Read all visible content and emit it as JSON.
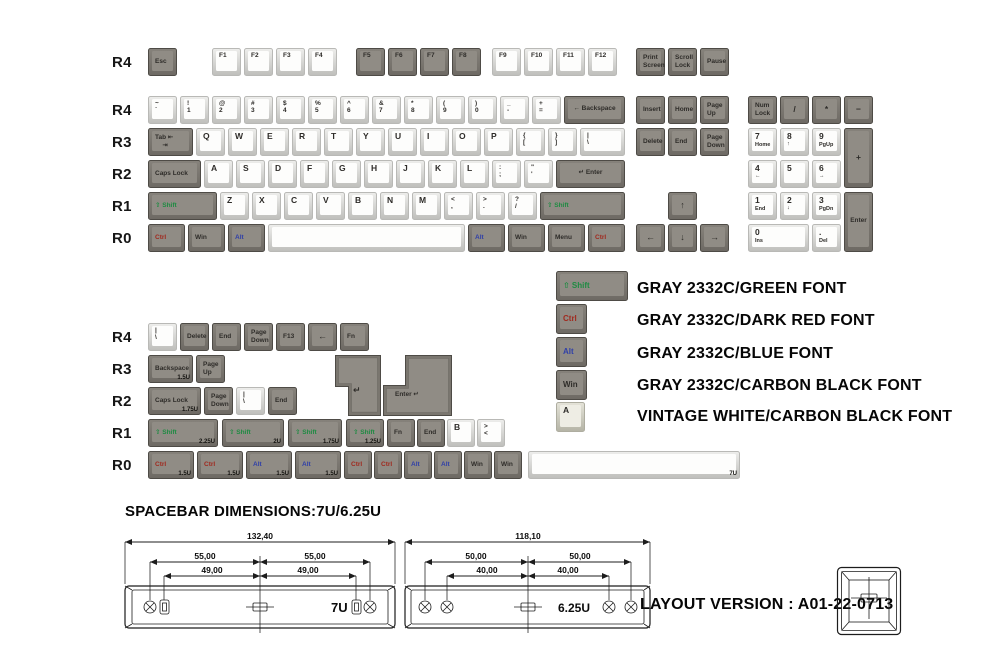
{
  "colors": {
    "green": "#1e8b42",
    "dark_red": "#a02a1f",
    "blue": "#3040a8",
    "carbon_black": "#2e2c29",
    "gray_keycap": "#908c85",
    "vintage_white": "#eeede4"
  },
  "texts": {
    "spacebar_note": "SPACEBAR DIMENSIONS:7U/6.25U",
    "layout_version": "LAYOUT VERSION : A01-22-0713"
  },
  "legend_panel": {
    "entries": [
      "GRAY 2332C/GREEN FONT",
      "GRAY 2332C/DARK RED FONT",
      "GRAY 2332C/BLUE FONT",
      "GRAY 2332C/CARBON BLACK FONT",
      "VINTAGE WHITE/CARBON BLACK FONT"
    ]
  },
  "diagrams": {
    "d7u": {
      "total": "132,40",
      "outer": "55,00",
      "inner": "49,00",
      "label": "7U"
    },
    "d625": {
      "total": "118,10",
      "outer": "50,00",
      "inner": "40,00",
      "label": "6.25U"
    }
  },
  "row_labels_main": [
    {
      "t": "R4",
      "y": 54
    },
    {
      "t": "R4",
      "y": 102
    },
    {
      "t": "R3",
      "y": 134
    },
    {
      "t": "R2",
      "y": 166
    },
    {
      "t": "R1",
      "y": 198
    },
    {
      "t": "R0",
      "y": 230
    }
  ],
  "row_labels_second": [
    {
      "t": "R4",
      "y": 329
    },
    {
      "t": "R3",
      "y": 361
    },
    {
      "t": "R2",
      "y": 393
    },
    {
      "t": "R1",
      "y": 425
    },
    {
      "t": "R0",
      "y": 457
    }
  ],
  "keys_main": [
    {
      "x": 148,
      "y": 48,
      "l": [
        "Esc"
      ]
    },
    {
      "x": 212,
      "y": 48,
      "c": "w",
      "l": [
        "F1"
      ]
    },
    {
      "x": 244,
      "y": 48,
      "c": "w",
      "l": [
        "F2"
      ]
    },
    {
      "x": 276,
      "y": 48,
      "c": "w",
      "l": [
        "F3"
      ]
    },
    {
      "x": 308,
      "y": 48,
      "c": "w",
      "l": [
        "F4"
      ]
    },
    {
      "x": 356,
      "y": 48,
      "l": [
        "F5"
      ],
      "pos": "tl"
    },
    {
      "x": 388,
      "y": 48,
      "l": [
        "F6"
      ],
      "pos": "tl"
    },
    {
      "x": 420,
      "y": 48,
      "l": [
        "F7"
      ],
      "pos": "tl"
    },
    {
      "x": 452,
      "y": 48,
      "l": [
        "F8"
      ],
      "pos": "tl"
    },
    {
      "x": 492,
      "y": 48,
      "c": "w",
      "l": [
        "F9"
      ]
    },
    {
      "x": 524,
      "y": 48,
      "c": "w",
      "l": [
        "F10"
      ]
    },
    {
      "x": 556,
      "y": 48,
      "c": "w",
      "l": [
        "F11"
      ]
    },
    {
      "x": 588,
      "y": 48,
      "c": "w",
      "l": [
        "F12"
      ]
    },
    {
      "x": 636,
      "y": 48,
      "l": [
        "Print",
        "Screen"
      ]
    },
    {
      "x": 668,
      "y": 48,
      "l": [
        "Scroll",
        "Lock"
      ]
    },
    {
      "x": 700,
      "y": 48,
      "l": [
        "Pause"
      ]
    },
    {
      "x": 148,
      "y": 96,
      "c": "w",
      "l": [
        "~",
        "`"
      ]
    },
    {
      "x": 180,
      "y": 96,
      "c": "w",
      "l": [
        "!",
        "1"
      ]
    },
    {
      "x": 212,
      "y": 96,
      "c": "w",
      "l": [
        "@",
        "2"
      ]
    },
    {
      "x": 244,
      "y": 96,
      "c": "w",
      "l": [
        "#",
        "3"
      ]
    },
    {
      "x": 276,
      "y": 96,
      "c": "w",
      "l": [
        "$",
        "4"
      ]
    },
    {
      "x": 308,
      "y": 96,
      "c": "w",
      "l": [
        "%",
        "5"
      ]
    },
    {
      "x": 340,
      "y": 96,
      "c": "w",
      "l": [
        "^",
        "6"
      ]
    },
    {
      "x": 372,
      "y": 96,
      "c": "w",
      "l": [
        "&",
        "7"
      ]
    },
    {
      "x": 404,
      "y": 96,
      "c": "w",
      "l": [
        "*",
        "8"
      ]
    },
    {
      "x": 436,
      "y": 96,
      "c": "w",
      "l": [
        "(",
        "9"
      ]
    },
    {
      "x": 468,
      "y": 96,
      "c": "w",
      "l": [
        ")",
        "0"
      ]
    },
    {
      "x": 500,
      "y": 96,
      "c": "w",
      "l": [
        "_",
        "-"
      ]
    },
    {
      "x": 532,
      "y": 96,
      "c": "w",
      "l": [
        "+",
        "="
      ]
    },
    {
      "x": 564,
      "y": 96,
      "w": 61,
      "l": [
        "← Backspace"
      ],
      "pos": "c"
    },
    {
      "x": 636,
      "y": 96,
      "l": [
        "Insert"
      ]
    },
    {
      "x": 668,
      "y": 96,
      "l": [
        "Home"
      ]
    },
    {
      "x": 700,
      "y": 96,
      "l": [
        "Page",
        "Up"
      ]
    },
    {
      "x": 748,
      "y": 96,
      "l": [
        "Num",
        "Lock"
      ]
    },
    {
      "x": 780,
      "y": 96,
      "l": [
        "/"
      ],
      "pos": "c"
    },
    {
      "x": 812,
      "y": 96,
      "l": [
        "*"
      ],
      "pos": "c"
    },
    {
      "x": 844,
      "y": 96,
      "l": [
        "−"
      ],
      "pos": "c"
    },
    {
      "x": 148,
      "y": 128,
      "w": 45,
      "l": [
        "Tab ⇤",
        "    ⇥"
      ]
    },
    {
      "x": 196,
      "y": 128,
      "c": "w",
      "l": [
        "Q"
      ]
    },
    {
      "x": 228,
      "y": 128,
      "c": "w",
      "l": [
        "W"
      ]
    },
    {
      "x": 260,
      "y": 128,
      "c": "w",
      "l": [
        "E"
      ]
    },
    {
      "x": 292,
      "y": 128,
      "c": "w",
      "l": [
        "R"
      ]
    },
    {
      "x": 324,
      "y": 128,
      "c": "w",
      "l": [
        "T"
      ]
    },
    {
      "x": 356,
      "y": 128,
      "c": "w",
      "l": [
        "Y"
      ]
    },
    {
      "x": 388,
      "y": 128,
      "c": "w",
      "l": [
        "U"
      ]
    },
    {
      "x": 420,
      "y": 128,
      "c": "w",
      "l": [
        "I"
      ]
    },
    {
      "x": 452,
      "y": 128,
      "c": "w",
      "l": [
        "O"
      ]
    },
    {
      "x": 484,
      "y": 128,
      "c": "w",
      "l": [
        "P"
      ]
    },
    {
      "x": 516,
      "y": 128,
      "c": "w",
      "l": [
        "{",
        "["
      ]
    },
    {
      "x": 548,
      "y": 128,
      "c": "w",
      "l": [
        "}",
        "]"
      ]
    },
    {
      "x": 580,
      "y": 128,
      "w": 45,
      "c": "w",
      "l": [
        "|",
        "\\"
      ]
    },
    {
      "x": 636,
      "y": 128,
      "l": [
        "Delete"
      ]
    },
    {
      "x": 668,
      "y": 128,
      "l": [
        "End"
      ]
    },
    {
      "x": 700,
      "y": 128,
      "l": [
        "Page",
        "Down"
      ]
    },
    {
      "x": 748,
      "y": 128,
      "c": "w",
      "np": 1,
      "l": [
        "7",
        "Home"
      ]
    },
    {
      "x": 780,
      "y": 128,
      "c": "w",
      "np": 1,
      "l": [
        "8",
        "↑"
      ]
    },
    {
      "x": 812,
      "y": 128,
      "c": "w",
      "np": 1,
      "l": [
        "9",
        "PgUp"
      ]
    },
    {
      "x": 844,
      "y": 128,
      "h": 60,
      "l": [
        "+"
      ],
      "pos": "c"
    },
    {
      "x": 148,
      "y": 160,
      "w": 53,
      "l": [
        "Caps Lock"
      ]
    },
    {
      "x": 204,
      "y": 160,
      "c": "w",
      "l": [
        "A"
      ]
    },
    {
      "x": 236,
      "y": 160,
      "c": "w",
      "l": [
        "S"
      ]
    },
    {
      "x": 268,
      "y": 160,
      "c": "w",
      "l": [
        "D"
      ]
    },
    {
      "x": 300,
      "y": 160,
      "c": "w",
      "l": [
        "F"
      ]
    },
    {
      "x": 332,
      "y": 160,
      "c": "w",
      "l": [
        "G"
      ]
    },
    {
      "x": 364,
      "y": 160,
      "c": "w",
      "l": [
        "H"
      ]
    },
    {
      "x": 396,
      "y": 160,
      "c": "w",
      "l": [
        "J"
      ]
    },
    {
      "x": 428,
      "y": 160,
      "c": "w",
      "l": [
        "K"
      ]
    },
    {
      "x": 460,
      "y": 160,
      "c": "w",
      "l": [
        "L"
      ]
    },
    {
      "x": 492,
      "y": 160,
      "c": "w",
      "l": [
        ":",
        ";"
      ]
    },
    {
      "x": 524,
      "y": 160,
      "c": "w",
      "l": [
        "\"",
        "'"
      ]
    },
    {
      "x": 556,
      "y": 160,
      "w": 69,
      "l": [
        "↵ Enter"
      ],
      "pos": "c"
    },
    {
      "x": 748,
      "y": 160,
      "c": "w",
      "np": 1,
      "l": [
        "4",
        "←"
      ]
    },
    {
      "x": 780,
      "y": 160,
      "c": "w",
      "np": 1,
      "l": [
        "5"
      ]
    },
    {
      "x": 812,
      "y": 160,
      "c": "w",
      "np": 1,
      "l": [
        "6",
        "→"
      ]
    },
    {
      "x": 148,
      "y": 192,
      "w": 69,
      "l": [
        "⇧ Shift"
      ],
      "lc": "gr"
    },
    {
      "x": 220,
      "y": 192,
      "c": "w",
      "l": [
        "Z"
      ]
    },
    {
      "x": 252,
      "y": 192,
      "c": "w",
      "l": [
        "X"
      ]
    },
    {
      "x": 284,
      "y": 192,
      "c": "w",
      "l": [
        "C"
      ]
    },
    {
      "x": 316,
      "y": 192,
      "c": "w",
      "l": [
        "V"
      ]
    },
    {
      "x": 348,
      "y": 192,
      "c": "w",
      "l": [
        "B"
      ]
    },
    {
      "x": 380,
      "y": 192,
      "c": "w",
      "l": [
        "N"
      ]
    },
    {
      "x": 412,
      "y": 192,
      "c": "w",
      "l": [
        "M"
      ]
    },
    {
      "x": 444,
      "y": 192,
      "c": "w",
      "l": [
        "<",
        ","
      ]
    },
    {
      "x": 476,
      "y": 192,
      "c": "w",
      "l": [
        ">",
        "."
      ]
    },
    {
      "x": 508,
      "y": 192,
      "c": "w",
      "l": [
        "?",
        "/"
      ]
    },
    {
      "x": 540,
      "y": 192,
      "w": 85,
      "l": [
        "⇧ Shift"
      ],
      "lc": "gr"
    },
    {
      "x": 668,
      "y": 192,
      "l": [
        "↑"
      ],
      "pos": "c"
    },
    {
      "x": 748,
      "y": 192,
      "c": "w",
      "np": 1,
      "l": [
        "1",
        "End"
      ]
    },
    {
      "x": 780,
      "y": 192,
      "c": "w",
      "np": 1,
      "l": [
        "2",
        "↓"
      ]
    },
    {
      "x": 812,
      "y": 192,
      "c": "w",
      "np": 1,
      "l": [
        "3",
        "PgDn"
      ]
    },
    {
      "x": 844,
      "y": 192,
      "h": 60,
      "l": [
        "Enter"
      ],
      "pos": "c"
    },
    {
      "x": 148,
      "y": 224,
      "w": 37,
      "l": [
        "Ctrl"
      ],
      "lc": "rd"
    },
    {
      "x": 188,
      "y": 224,
      "w": 37,
      "l": [
        "Win"
      ]
    },
    {
      "x": 228,
      "y": 224,
      "w": 37,
      "l": [
        "Alt"
      ],
      "lc": "bl"
    },
    {
      "n": "key-spacebar",
      "x": 268,
      "y": 224,
      "w": 197,
      "c": "w",
      "l": []
    },
    {
      "x": 468,
      "y": 224,
      "w": 37,
      "l": [
        "Alt"
      ],
      "lc": "bl"
    },
    {
      "x": 508,
      "y": 224,
      "w": 37,
      "l": [
        "Win"
      ]
    },
    {
      "x": 548,
      "y": 224,
      "w": 37,
      "l": [
        "Menu"
      ]
    },
    {
      "x": 588,
      "y": 224,
      "w": 37,
      "l": [
        "Ctrl"
      ],
      "lc": "rd"
    },
    {
      "x": 636,
      "y": 224,
      "l": [
        "←"
      ],
      "pos": "c"
    },
    {
      "x": 668,
      "y": 224,
      "l": [
        "↓"
      ],
      "pos": "c"
    },
    {
      "x": 700,
      "y": 224,
      "l": [
        "→"
      ],
      "pos": "c"
    },
    {
      "x": 748,
      "y": 224,
      "w": 61,
      "c": "w",
      "np": 1,
      "l": [
        "0",
        "Ins"
      ]
    },
    {
      "x": 812,
      "y": 224,
      "c": "w",
      "np": 1,
      "l": [
        ".",
        "Del"
      ]
    }
  ],
  "keys_second": [
    {
      "x": 148,
      "y": 323,
      "c": "w",
      "l": [
        "|",
        "\\"
      ]
    },
    {
      "x": 180,
      "y": 323,
      "l": [
        "Delete"
      ]
    },
    {
      "x": 212,
      "y": 323,
      "l": [
        "End"
      ]
    },
    {
      "x": 244,
      "y": 323,
      "l": [
        "Page",
        "Down"
      ]
    },
    {
      "x": 276,
      "y": 323,
      "l": [
        "F13"
      ]
    },
    {
      "x": 308,
      "y": 323,
      "l": [
        "←"
      ],
      "pos": "c"
    },
    {
      "x": 340,
      "y": 323,
      "l": [
        "Fn"
      ]
    },
    {
      "x": 148,
      "y": 355,
      "w": 45,
      "l": [
        "Backspace"
      ],
      "sub": "1.5U"
    },
    {
      "x": 196,
      "y": 355,
      "l": [
        "Page",
        "Up"
      ]
    },
    {
      "x": 148,
      "y": 387,
      "w": 53,
      "l": [
        "Caps Lock"
      ],
      "sub": "1.75U"
    },
    {
      "x": 204,
      "y": 387,
      "l": [
        "Page",
        "Down"
      ]
    },
    {
      "x": 236,
      "y": 387,
      "c": "w",
      "l": [
        "|",
        "\\"
      ]
    },
    {
      "x": 268,
      "y": 387,
      "l": [
        "End"
      ]
    },
    {
      "x": 148,
      "y": 419,
      "w": 70,
      "l": [
        "⇧ Shift"
      ],
      "lc": "gr",
      "sub": "2.25U"
    },
    {
      "x": 222,
      "y": 419,
      "w": 62,
      "l": [
        "⇧ Shift"
      ],
      "lc": "gr",
      "sub": "2U"
    },
    {
      "x": 288,
      "y": 419,
      "w": 54,
      "l": [
        "⇧ Shift"
      ],
      "lc": "gr",
      "sub": "1.75U"
    },
    {
      "x": 346,
      "y": 419,
      "w": 38,
      "l": [
        "⇧ Shift"
      ],
      "lc": "gr",
      "sub": "1.25U"
    },
    {
      "x": 387,
      "y": 419,
      "w": 28,
      "l": [
        "Fn"
      ]
    },
    {
      "x": 417,
      "y": 419,
      "w": 28,
      "l": [
        "End"
      ]
    },
    {
      "x": 447,
      "y": 419,
      "w": 28,
      "c": "w",
      "l": [
        "B"
      ]
    },
    {
      "x": 477,
      "y": 419,
      "w": 28,
      "c": "w",
      "l": [
        ">",
        "<"
      ]
    },
    {
      "x": 148,
      "y": 451,
      "w": 46,
      "l": [
        "Ctrl"
      ],
      "lc": "rd",
      "sub": "1.5U"
    },
    {
      "x": 197,
      "y": 451,
      "w": 46,
      "l": [
        "Ctrl"
      ],
      "lc": "rd",
      "sub": "1.5U"
    },
    {
      "x": 246,
      "y": 451,
      "w": 46,
      "l": [
        "Alt"
      ],
      "lc": "bl",
      "sub": "1.5U"
    },
    {
      "x": 295,
      "y": 451,
      "w": 46,
      "l": [
        "Alt"
      ],
      "lc": "bl",
      "sub": "1.5U"
    },
    {
      "x": 344,
      "y": 451,
      "w": 28,
      "l": [
        "Ctrl"
      ],
      "lc": "rd"
    },
    {
      "x": 374,
      "y": 451,
      "w": 28,
      "l": [
        "Ctrl"
      ],
      "lc": "rd"
    },
    {
      "x": 404,
      "y": 451,
      "w": 28,
      "l": [
        "Alt"
      ],
      "lc": "bl"
    },
    {
      "x": 434,
      "y": 451,
      "w": 28,
      "l": [
        "Alt"
      ],
      "lc": "bl"
    },
    {
      "x": 464,
      "y": 451,
      "w": 28,
      "l": [
        "Win"
      ]
    },
    {
      "x": 494,
      "y": 451,
      "w": 28,
      "l": [
        "Win"
      ]
    },
    {
      "n": "key-spacebar-7u",
      "x": 528,
      "y": 451,
      "w": 212,
      "c": "w",
      "l": [],
      "sub": "7U"
    }
  ],
  "enter_keys": [
    {
      "n": "key-iso-enter",
      "x": 335,
      "y": 355,
      "kind": "iso",
      "legend": "↵"
    },
    {
      "n": "key-big-ass-enter",
      "x": 383,
      "y": 355,
      "kind": "bae",
      "legend": "Enter ↵"
    }
  ],
  "sample_keys": [
    {
      "n": "sample-key-shift",
      "x": 556,
      "y": 271,
      "w": 72,
      "h": 30,
      "l": [
        "⇧ Shift"
      ],
      "lc": "gr",
      "fs": 8
    },
    {
      "n": "sample-key-ctrl",
      "x": 556,
      "y": 304,
      "w": 31,
      "h": 30,
      "l": [
        "Ctrl"
      ],
      "lc": "rd",
      "fs": 8
    },
    {
      "n": "sample-key-alt",
      "x": 556,
      "y": 337,
      "w": 31,
      "h": 30,
      "l": [
        "Alt"
      ],
      "lc": "bl",
      "fs": 8
    },
    {
      "n": "sample-key-win",
      "x": 556,
      "y": 370,
      "w": 31,
      "h": 30,
      "l": [
        "Win"
      ],
      "fs": 8
    },
    {
      "n": "sample-key-a",
      "x": 556,
      "y": 402,
      "w": 29,
      "h": 30,
      "c": "v",
      "l": [
        "A"
      ],
      "pos": "tl"
    }
  ]
}
